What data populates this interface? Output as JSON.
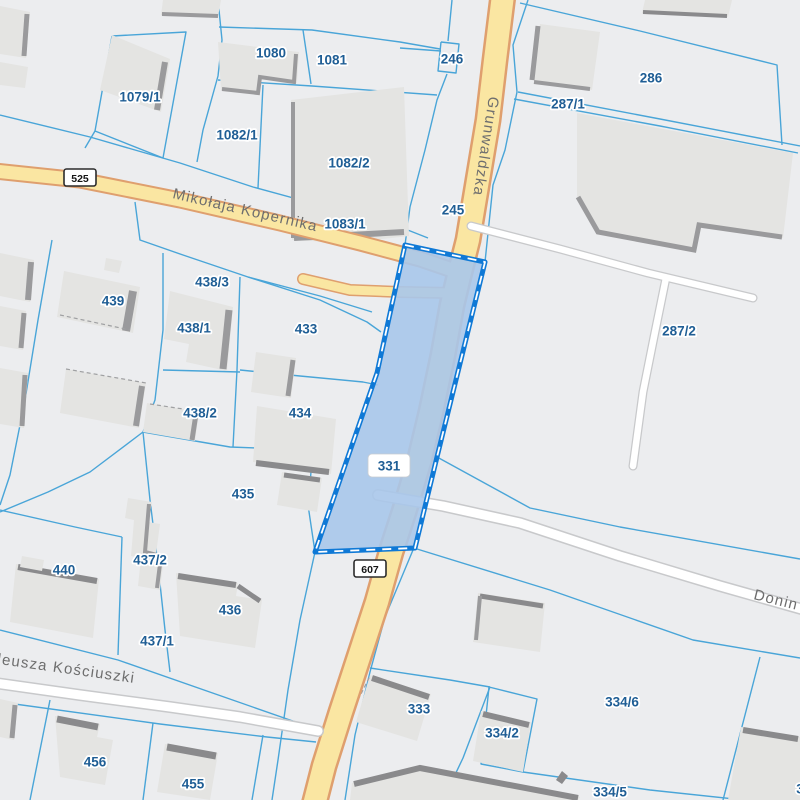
{
  "map": {
    "colors": {
      "background": "#ECEDEF",
      "boundary": "#49A5D8",
      "selection_fill": "#A9C7EA",
      "selection_stroke": "#0F79D6",
      "selection_dash": "#FFFFFF",
      "road_fill": "#FAE6A2",
      "road_casing": "#DF9F6E",
      "white_road_fill": "#FFFFFF",
      "white_road_casing": "#C8C9CB",
      "building_fill": "#E4E4E2",
      "building_shadow": "#9A9A9C",
      "building_shadow_dark": "#8A8A8C",
      "dashed_outline": "#9FA0A2",
      "parcel_label_color": "#1F5E95",
      "street_label_color": "#6E6E6E",
      "badge_bg": "#FFFFFF",
      "badge_border": "#2B2B2B",
      "badge_text": "#151515"
    },
    "selected_parcel": {
      "label": "331",
      "points": "405,245 485,262 437,457 415,548 315,552 377,373",
      "label_box": {
        "x": 368,
        "y": 454,
        "w": 42,
        "h": 23
      },
      "label_x": 389,
      "label_y": 466
    },
    "road_badges": [
      {
        "label": "525",
        "x": 80,
        "y": 178
      },
      {
        "label": "607",
        "x": 370,
        "y": 569
      }
    ],
    "street_labels": [
      {
        "text": "Mikołaja Kopernika",
        "x": 172,
        "y": 198,
        "rotate": 13
      },
      {
        "text": "Grunwaldzka",
        "x": 489,
        "y": 96,
        "rotate": 99
      },
      {
        "text": "deusza Kościuszki",
        "x": -8,
        "y": 663,
        "rotate": 8
      },
      {
        "text": "Donin",
        "x": 753,
        "y": 599,
        "rotate": 14
      }
    ],
    "parcel_labels": [
      {
        "text": "1079/1",
        "x": 140,
        "y": 97
      },
      {
        "text": "1080",
        "x": 271,
        "y": 53
      },
      {
        "text": "1081",
        "x": 332,
        "y": 60
      },
      {
        "text": "246",
        "x": 452,
        "y": 59
      },
      {
        "text": "286",
        "x": 651,
        "y": 78
      },
      {
        "text": "287/1",
        "x": 568,
        "y": 104
      },
      {
        "text": "1082/1",
        "x": 237,
        "y": 135
      },
      {
        "text": "1082/2",
        "x": 349,
        "y": 163
      },
      {
        "text": "1083/1",
        "x": 345,
        "y": 224
      },
      {
        "text": "245",
        "x": 453,
        "y": 210
      },
      {
        "text": "287/2",
        "x": 679,
        "y": 331
      },
      {
        "text": "438/3",
        "x": 212,
        "y": 282
      },
      {
        "text": "439",
        "x": 113,
        "y": 301
      },
      {
        "text": "438/1",
        "x": 194,
        "y": 328
      },
      {
        "text": "433",
        "x": 306,
        "y": 329
      },
      {
        "text": "438/2",
        "x": 200,
        "y": 413
      },
      {
        "text": "434",
        "x": 300,
        "y": 413
      },
      {
        "text": "435",
        "x": 243,
        "y": 494
      },
      {
        "text": "437/2",
        "x": 150,
        "y": 560
      },
      {
        "text": "440",
        "x": 64,
        "y": 570
      },
      {
        "text": "436",
        "x": 230,
        "y": 610
      },
      {
        "text": "437/1",
        "x": 157,
        "y": 641
      },
      {
        "text": "456",
        "x": 95,
        "y": 762
      },
      {
        "text": "455",
        "x": 193,
        "y": 784
      },
      {
        "text": "333",
        "x": 419,
        "y": 709
      },
      {
        "text": "334/2",
        "x": 502,
        "y": 733
      },
      {
        "text": "334/6",
        "x": 622,
        "y": 702
      },
      {
        "text": "334/5",
        "x": 610,
        "y": 792
      },
      {
        "text": "3",
        "x": 800,
        "y": 789
      }
    ],
    "roads": [
      {
        "name": "grunwaldzka-607",
        "fill_w": 22,
        "case_w": 27,
        "pts": "503,-5 495,60 488,120 478,180 468,240 460,272 452,305 443,355 431,412 419,462 404,512 391,552 377,602 359,657 341,712 324,766 314,805"
      },
      {
        "name": "mikolaja-kopernika-525",
        "fill_w": 13,
        "case_w": 17,
        "pts": "-5,171 80,180 180,200 280,223 360,243 420,259 458,272"
      },
      {
        "name": "road-spur",
        "fill_w": 9,
        "case_w": 12,
        "pts": "303,279 350,290 400,292 452,293"
      }
    ],
    "white_roads": [
      {
        "name": "driveway-287-2",
        "fill_w": 6.5,
        "case_w": 9,
        "pts": "471,226 560,249 648,273 753,298"
      },
      {
        "name": "driveway-287-2-branch",
        "fill_w": 6.5,
        "case_w": 9,
        "pts": "666,278 655,332 643,392 633,466"
      },
      {
        "name": "kosciuszki-road",
        "fill_w": 9,
        "case_w": 12,
        "pts": "-5,683 80,695 170,707 240,717 318,731"
      },
      {
        "name": "donin-road",
        "fill_w": 9,
        "case_w": 12,
        "pts": "378,495 443,506 520,523 620,556 720,586 805,610"
      }
    ],
    "boundaries": [
      "112,36 186,32 163,158 95,131 112,36",
      "0,115 90,137 180,163 253,187 330,208 395,225 428,238",
      "218,0 222,40 218,76 203,130 197,162",
      "218,80 312,86 437,95",
      "219,27 312,30 400,42 440,49",
      "303,30 311,84",
      "263,85 258,188",
      "441,42 459,44 456,73 438,71 441,42",
      "452,0 448,41",
      "400,48 441,51",
      "447,74 437,100 425,150 410,207 405,245",
      "528,0 513,45 517,92 505,150 493,185 485,262",
      "520,3 640,31 777,65 782,145",
      "518,92 660,119 800,146",
      "514,99 660,126 798,153",
      "417,549 550,590 693,640 800,658",
      "437,457 530,508 620,527 800,559",
      "760,657 723,800",
      "370,668 450,680 490,687",
      "490,687 463,758 443,800",
      "489,687 537,699 523,772 481,764 489,687",
      "523,772 650,790 800,806",
      "0,630 118,660 310,727",
      "0,702 160,724 267,737 316,742",
      "50,700 30,800",
      "153,723 143,800",
      "263,735 252,800",
      "315,552 300,620 288,690 278,760 272,800",
      "413,550 385,617 370,672 355,735 345,800",
      "135,202 140,240 183,255 248,277 320,300 367,322 381,332",
      "248,277 320,296 372,312",
      "163,253 163,330 155,400 143,432",
      "143,432 90,472 48,492 0,512",
      "143,432 230,447 313,450",
      "240,277 237,370 233,447",
      "163,370 240,372",
      "240,370 300,376 363,382 378,385",
      "313,450 308,505 315,552",
      "52,240 38,320 25,400 10,475 0,505",
      "0,510 75,527 122,537",
      "122,537 118,655",
      "143,432 150,500 158,565 165,630 170,672",
      "95,131 85,148"
    ],
    "buildings": [
      {
        "pts": "163,0 221,0 218,17 161,15",
        "shadows": [
          [
            "162,14 218,16",
            4,
            0
          ]
        ]
      },
      {
        "pts": "645,0 732,0 728,17 642,13",
        "shadows": [
          [
            "643,12 727,16",
            4,
            1
          ]
        ]
      },
      {
        "pts": "218,42 299,52 297,83 261,78 259,94 221,90",
        "shadows": [
          [
            "296,54 294,82 260,77 258,93 222,89",
            4,
            0
          ]
        ]
      },
      {
        "pts": "112,35 170,59 161,112 100,90",
        "shadows": [
          [
            "165,62 157,110",
            6,
            0
          ]
        ]
      },
      {
        "pts": "0,6 30,12 26,58 0,54",
        "shadows": [
          [
            "27,14 24,56",
            5,
            0
          ]
        ]
      },
      {
        "pts": "0,62 28,67 25,88 0,85",
        "shadows": []
      },
      {
        "pts": "291,100 404,87 409,236 346,243 292,240",
        "shadows": [
          [
            "293,102 293,238",
            4,
            0
          ],
          [
            "294,238 404,232",
            6,
            0
          ]
        ]
      },
      {
        "pts": "540,24 600,32 592,90 534,81",
        "shadows": [
          [
            "538,26 532,80",
            5,
            0
          ],
          [
            "534,82 590,89",
            4,
            0
          ]
        ]
      },
      {
        "pts": "577,113 793,153 783,238 700,224 694,252 598,234 577,196",
        "shadows": [
          [
            "578,197 598,232 694,250 699,225 782,237",
            5,
            0
          ]
        ]
      },
      {
        "pts": "256,352 296,358 291,398 251,392",
        "shadows": [
          [
            "293,360 288,396",
            5,
            0
          ]
        ]
      },
      {
        "pts": "64,271 140,287 133,333 57,317",
        "shadows": [
          [
            "133,291 126,331",
            8,
            0
          ]
        ]
      },
      {
        "pts": "106,258 122,261 119,273 104,270",
        "shadows": []
      },
      {
        "pts": "170,291 233,307 227,371 186,362 189,344 164,339",
        "shadows": [
          [
            "229,310 223,369",
            7,
            0
          ]
        ]
      },
      {
        "pts": "66,369 146,383 139,428 60,413",
        "shadows": [
          [
            "142,386 136,426",
            6,
            0
          ]
        ]
      },
      {
        "pts": "147,403 199,412 195,441 143,432",
        "shadows": [
          [
            "196,414 192,440",
            5,
            0
          ]
        ]
      },
      {
        "pts": "257,406 336,419 331,474 253,462",
        "shadows": [
          [
            "256,463 329,472",
            6,
            1
          ]
        ]
      },
      {
        "pts": "282,472 322,478 317,512 277,505",
        "shadows": [
          [
            "284,475 320,480",
            5,
            1
          ]
        ]
      },
      {
        "pts": "16,564 99,579 93,638 10,622",
        "shadows": [
          [
            "18,567 97,581",
            6,
            1
          ]
        ]
      },
      {
        "pts": "22,556 44,560 42,571 20,567",
        "shadows": []
      },
      {
        "pts": "128,498 152,502 148,522 160,524 156,554 164,556 160,590 138,586 141,558 131,556 134,520 125,518",
        "shadows": [
          [
            "149,504 145,552 161,556 157,588",
            4,
            0
          ]
        ]
      },
      {
        "pts": "176,573 238,583 236,596 262,600 255,648 180,636",
        "shadows": [
          [
            "178,576 236,585",
            6,
            1
          ],
          [
            "238,586 260,601",
            5,
            1
          ]
        ]
      },
      {
        "pts": "55,716 100,724 97,737 113,740 105,785 60,777",
        "shadows": [
          [
            "57,719 98,727",
            7,
            1
          ]
        ]
      },
      {
        "pts": "165,744 218,753 210,800 157,792",
        "shadows": [
          [
            "167,747 216,756",
            7,
            1
          ]
        ]
      },
      {
        "pts": "370,675 431,694 417,741 356,722",
        "shadows": [
          [
            "372,678 429,697",
            6,
            1
          ]
        ]
      },
      {
        "pts": "481,711 531,722 523,772 473,761",
        "shadows": [
          [
            "483,714 529,725",
            6,
            1
          ]
        ]
      },
      {
        "pts": "352,783 420,765 580,797 578,800 350,800",
        "shadows": [
          [
            "354,784 420,768 578,798",
            6,
            1
          ]
        ]
      },
      {
        "pts": "478,593 545,603 540,652 473,642",
        "shadows": [
          [
            "480,596 543,606",
            5,
            1
          ],
          [
            "480,596 476,640",
            4,
            0
          ]
        ]
      },
      {
        "pts": "741,727 800,737 800,800 728,800",
        "shadows": [
          [
            "743,730 798,739",
            6,
            1
          ]
        ]
      },
      {
        "pts": "0,253 34,260 30,302 0,296",
        "shadows": [
          [
            "31,262 28,300",
            6,
            0
          ]
        ]
      },
      {
        "pts": "0,306 26,311 23,350 0,346",
        "shadows": [
          [
            "24,313 21,348",
            5,
            0
          ]
        ]
      },
      {
        "pts": "0,368 28,373 24,428 0,424",
        "shadows": [
          [
            "25,375 22,426",
            5,
            0
          ]
        ]
      },
      {
        "pts": "0,699 18,703 14,740 0,737",
        "shadows": [
          [
            "15,705 12,738",
            5,
            0
          ]
        ]
      },
      {
        "pts": "556,780 562,771 568,776 562,784",
        "dark_fill": true,
        "shadows": []
      }
    ],
    "dashed_outlines": [
      "66,369 146,383",
      "150,404 203,412",
      "60,315 130,330",
      "358,700 370,676"
    ]
  }
}
